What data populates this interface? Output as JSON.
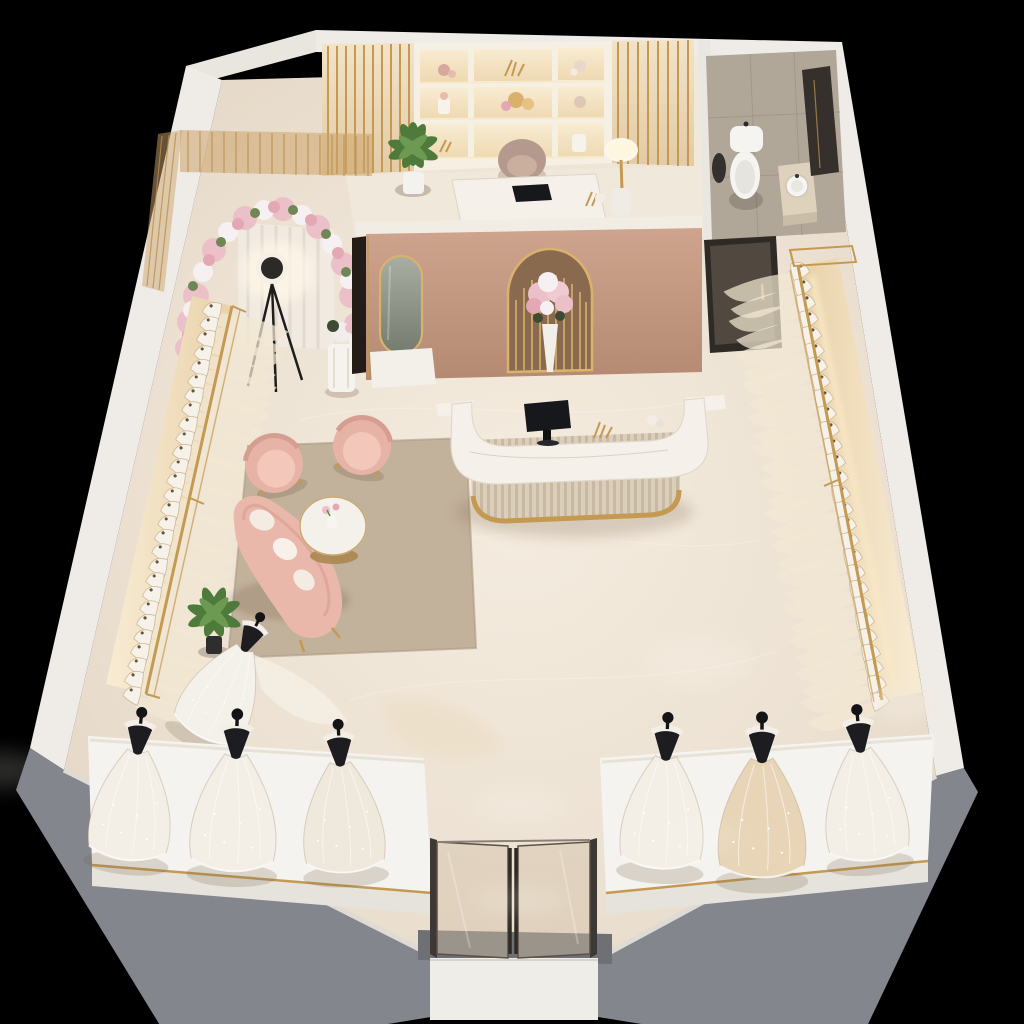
{
  "scene": {
    "description": "Photorealistic 3D isometric cutaway floor plan of a bridal gown boutique on a black background",
    "view": "isometric cutaway from above-front",
    "background": "#000000"
  },
  "palette": {
    "background": "#000000",
    "wall_white": "#efece7",
    "wall_inner": "#e9e5df",
    "wall_grey": "#83868d",
    "floor": "#ebe0d2",
    "floor_light": "#f6efe5",
    "office_floor": "#f0e8db",
    "bathroom_floor": "#b1a798",
    "tile_seam": "#a29888",
    "pink_wall": "#c79c86",
    "pink_wall_deep": "#b5886f",
    "pink_cap": "#f1ece4",
    "gold": "#c49a52",
    "gold_bright": "#ecd3a0",
    "glow_warm": "#f9e9c8",
    "shelf": "#f5efe4",
    "slat_bg": "#ead9bf",
    "curtain": "#f1eae1",
    "flower_pink": "#ecc0c8",
    "flower_rose": "#e3a8b4",
    "flower_white": "#f7f0f2",
    "leaf_green": "#6f8655",
    "plant_green": "#4e7a3c",
    "blush": "#e9b7aa",
    "blush_light": "#f3c9bc",
    "rug": "#c2b19b",
    "marble_top": "#f5f1ea",
    "flute_a": "#dbceba",
    "flute_b": "#c9baa4",
    "monitor": "#17181b",
    "mannequin_black": "#1b1b1e",
    "dress_white": "#f3eee6",
    "dress_ivory": "#efe8dc",
    "champagne": "#e8d5b8",
    "platform": "#f5f3ef",
    "platform_side": "#e6e3dd",
    "door_dark": "#443c35",
    "glass": "#d2c0a6",
    "mirror_a": "#a9aea3",
    "mirror_b": "#747b6e",
    "toilet": "#f5f4f1",
    "shadow": "#c9b8a3"
  },
  "rooms": [
    {
      "name": "showroom",
      "floor": "cream marble"
    },
    {
      "name": "back-office",
      "features": [
        "gold-slat-accent-wall",
        "lit-display-shelving",
        "white-desk-with-laptop",
        "office-chair",
        "potted-plant",
        "table-lamp"
      ]
    },
    {
      "name": "restroom",
      "features": [
        "toilet",
        "vanity-with-round-sink",
        "dark-mirror-cabinet",
        "dark-glass-door",
        "greige-tile-floor"
      ]
    },
    {
      "name": "photo-corner",
      "features": [
        "pink-white-floral-arch",
        "sheer-curtain-backdrop",
        "black-tripod-ring-light",
        "gold-mesh-screens",
        "white-pedestal-with-flowers"
      ]
    },
    {
      "name": "entrance-vestibule",
      "features": [
        "double-glass-door",
        "white-mat"
      ]
    }
  ],
  "showroom": {
    "pink_feature_wall": [
      "arched-gold-fluted-niche-with-flower-vase",
      "arched-gold-framed-mirror"
    ],
    "reception": [
      "curved-fluted-reception-desk",
      "white-marble-top",
      "gold-base-trim",
      "black-monitor",
      "gold-coral-decor"
    ],
    "lounge": [
      "blush-armchair",
      "blush-armchair",
      "curved-blush-sofa-with-white-pillows",
      "round-marble-coffee-table-gold-base",
      "beige-area-rug",
      "small-flower-vase"
    ],
    "dress_racks": [
      {
        "side": "left",
        "dress_count": 28,
        "rail": "gold",
        "lighting": "warm backlight"
      },
      {
        "side": "right",
        "dress_count": 28,
        "rail": "gold",
        "lighting": "warm backlight"
      }
    ],
    "display_platforms": [
      {
        "side": "left",
        "mannequins": 3,
        "gown_colors": [
          "white",
          "white",
          "ivory"
        ]
      },
      {
        "side": "right",
        "mannequins": 3,
        "gown_colors": [
          "white",
          "champagne",
          "white"
        ]
      }
    ],
    "freestanding_mannequins": 1,
    "plants": 2
  }
}
